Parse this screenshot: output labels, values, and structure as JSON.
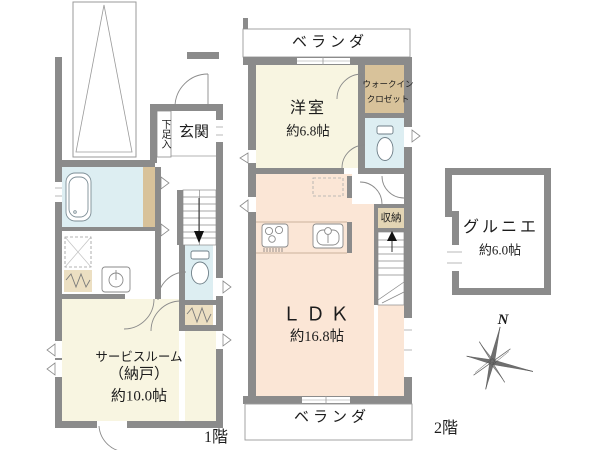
{
  "palette": {
    "wall_gray": "#8b8b8b",
    "water_blue": "#ddeef2",
    "room_cream": "#f8f5e1",
    "room_peach": "#fbe6d6",
    "closet_tan": "#d8c29a",
    "closet_beige": "#ecdfc2",
    "storage_beige": "#e3d5b4",
    "line_gray": "#8a8a8a",
    "text_dark": "#1c1c1c"
  },
  "floor1": {
    "floor_label": "1階",
    "entrance_label": "玄関",
    "shoe_cabinet_label": "下足入",
    "bathroom_label": "浴室",
    "washroom_label": "洗面所",
    "service_room_label": "サービスルーム",
    "service_room_label2": "（納戸）",
    "service_room_area": "約10.0帖"
  },
  "floor2": {
    "floor_label": "2階",
    "veranda_top_label": "ベランダ",
    "veranda_bottom_label": "ベランダ",
    "western_room_label": "洋室",
    "western_room_area": "約6.8帖",
    "wic_label_line1": "ウォークイン",
    "wic_label_line2": "クロゼット",
    "ldk_label": "ＬＤＫ",
    "ldk_area": "約16.8帖",
    "storage_label": "収納"
  },
  "attic": {
    "grenier_label": "グルニエ",
    "grenier_area": "約6.0帖"
  },
  "compass": {
    "north_label": "N"
  }
}
